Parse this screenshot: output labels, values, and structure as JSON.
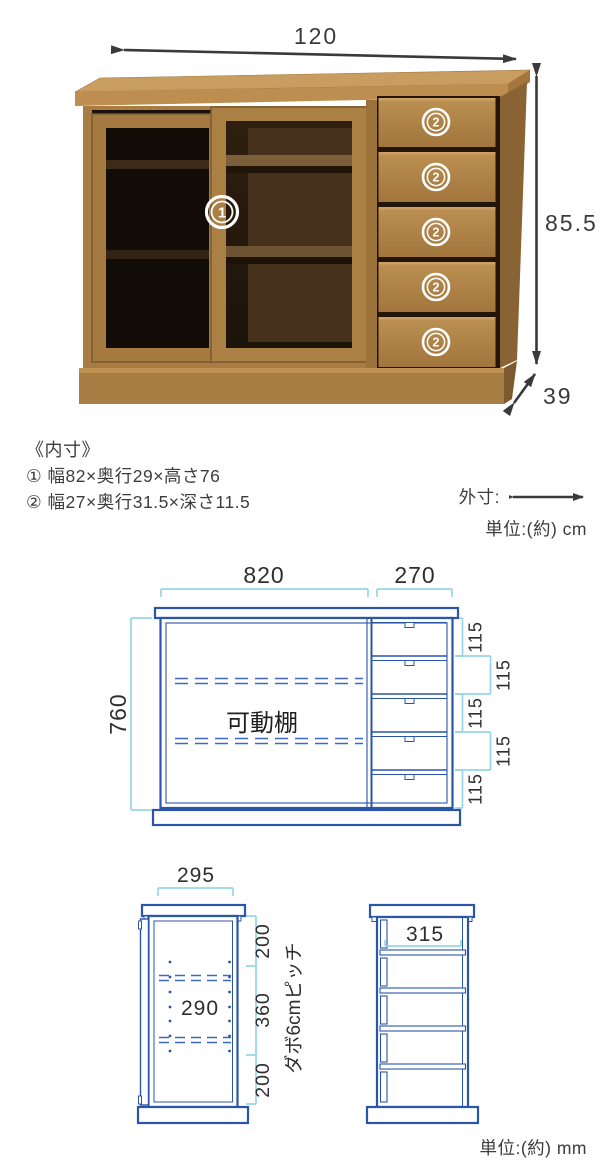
{
  "colors": {
    "drawing_blue": "#2b55a8",
    "dashed_shelf_blue": "#3f69bc",
    "dimension_cyan": "#97d6e6",
    "dimension_text": "#2e2e2e",
    "photo_arrow_gray": "#3a3a3a",
    "wood_top": "#c99c60",
    "wood_front": "#a87c42",
    "wood_side": "#8a6334",
    "badge_white": "#ffffff"
  },
  "photo": {
    "width_label": "120",
    "height_label": "85.5",
    "depth_label": "39",
    "door_badge": "1",
    "drawer_badge": "2"
  },
  "specs": {
    "heading": "《内寸》",
    "items": [
      {
        "label": "① 幅82×奥行29×高さ76"
      },
      {
        "label": "② 幅27×奥行31.5×深さ11.5"
      }
    ],
    "outer_dim_label": "外寸:",
    "unit_note_cm": "単位:(約) cm"
  },
  "front_view": {
    "opening_width": "820",
    "drawer_width": "270",
    "opening_height": "760",
    "shelf_label": "可動棚",
    "drawer_pitches": [
      "115",
      "115",
      "115",
      "115",
      "115"
    ]
  },
  "side_view_shelf": {
    "outer_width": "295",
    "inner_width": "290",
    "top_gap": "200",
    "middle_span": "360",
    "bottom_gap": "200",
    "pitch_note": "ダボ6cmピッチ"
  },
  "side_view_drawer": {
    "inner_width": "315"
  },
  "unit_note_mm": "単位:(約) mm"
}
